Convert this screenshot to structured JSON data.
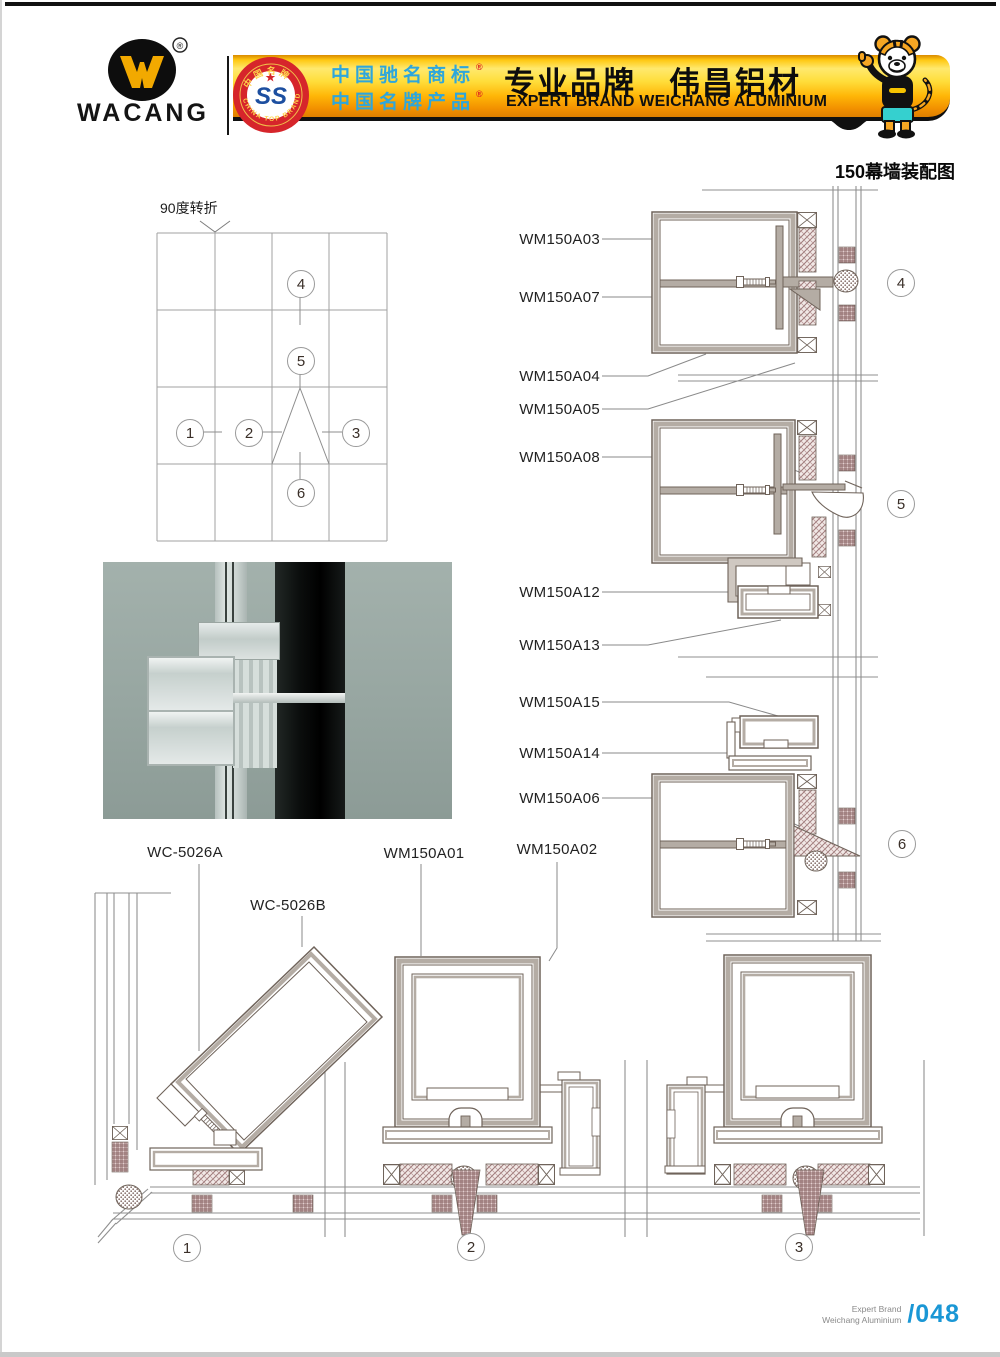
{
  "header": {
    "logo": {
      "brand": "WACANG",
      "reg": "®"
    },
    "badge": {
      "arc_top": "中国名牌",
      "arc_bottom": "CHINA TOP BRAND",
      "emblem": "SS"
    },
    "banner": {
      "cn_line1": "中国驰名商标",
      "cn_line1_reg": "®",
      "cn_line2": "中国名牌产品",
      "cn_line2_reg": "®",
      "headline_cn": "专业品牌　伟昌铝材",
      "subline_en": "EXPERT BRAND WEICHANG ALUMINIUM"
    }
  },
  "page_title": "150幕墙装配图",
  "schematic": {
    "corner_label": "90度转折"
  },
  "callouts": {
    "n1": "1",
    "n2": "2",
    "n3": "3",
    "n4": "4",
    "n5": "5",
    "n6": "6"
  },
  "parts": {
    "a03": "WM150A03",
    "a07": "WM150A07",
    "a04": "WM150A04",
    "a05": "WM150A05",
    "a08": "WM150A08",
    "a12": "WM150A12",
    "a13": "WM150A13",
    "a15": "WM150A15",
    "a14": "WM150A14",
    "a06": "WM150A06",
    "wc_a": "WC-5026A",
    "wc_b": "WC-5026B",
    "a01": "WM150A01",
    "a02": "WM150A02"
  },
  "footer": {
    "brand_line1": "Expert Brand",
    "brand_line2": "Weichang Aluminium",
    "page_no": "/048"
  },
  "colors": {
    "banner_gold": "#ffc812",
    "accent_blue": "#2ea6dc",
    "badge_red": "#d6252b",
    "page_no_blue": "#1a97d5",
    "line": "#6f635a",
    "hatch": "#9d7a7a"
  }
}
